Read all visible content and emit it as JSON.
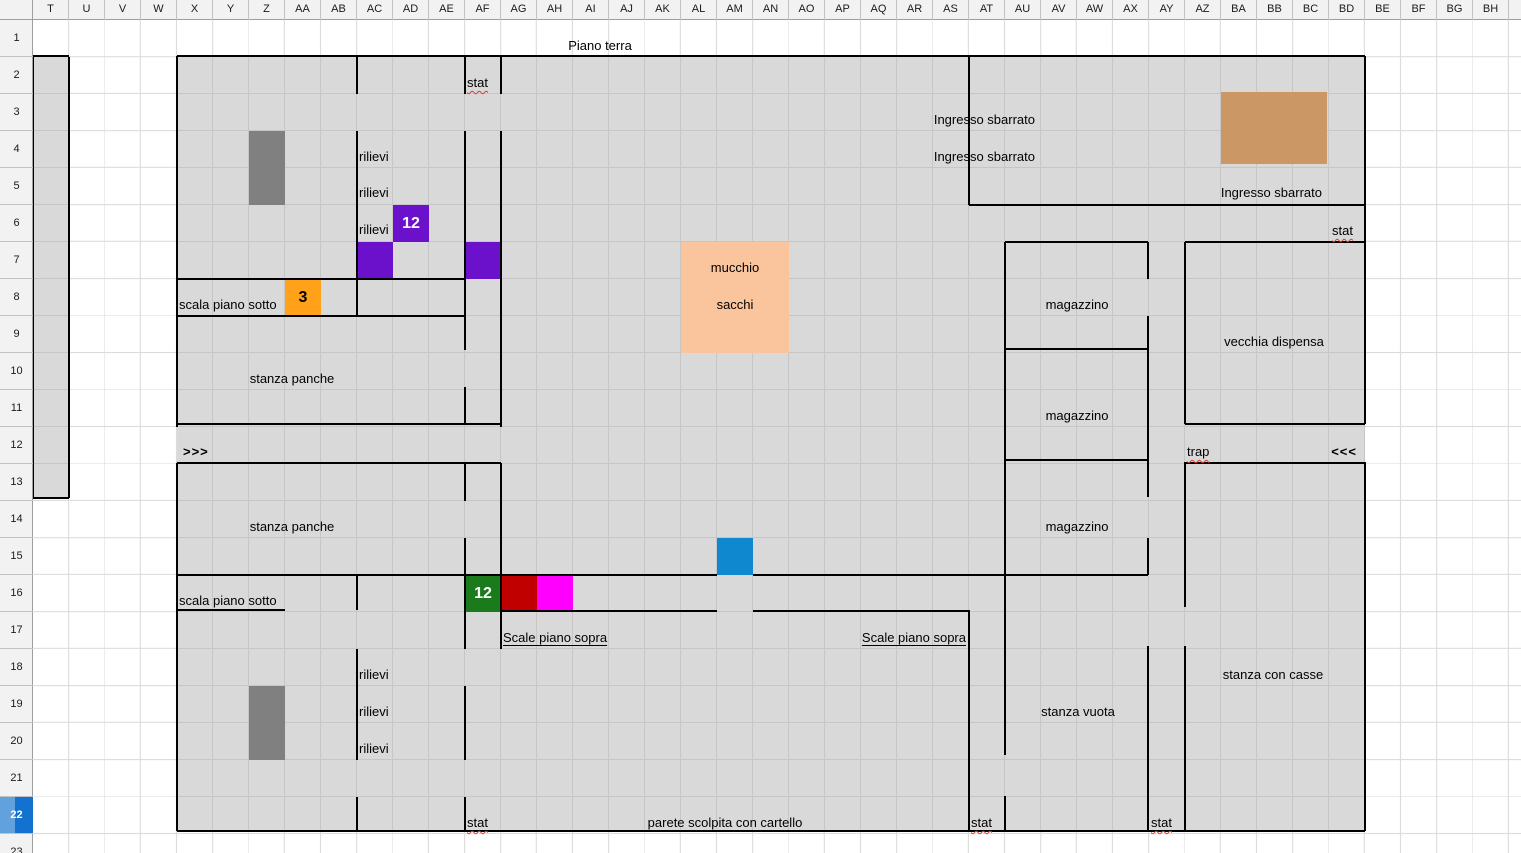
{
  "sheet": {
    "title_cell_text": "Piano terra",
    "column_headers": [
      "T",
      "U",
      "V",
      "W",
      "X",
      "Y",
      "Z",
      "AA",
      "AB",
      "AC",
      "AD",
      "AE",
      "AF",
      "AG",
      "AH",
      "AI",
      "AJ",
      "AK",
      "AL",
      "AM",
      "AN",
      "AO",
      "AP",
      "AQ",
      "AR",
      "AS",
      "AT",
      "AU",
      "AV",
      "AW",
      "AX",
      "AY",
      "AZ",
      "BA",
      "BB",
      "BC",
      "BD",
      "BE",
      "BF",
      "BG",
      "BH"
    ],
    "row_headers": [
      "1",
      "2",
      "3",
      "4",
      "5",
      "6",
      "7",
      "8",
      "9",
      "10",
      "11",
      "12",
      "13",
      "14",
      "15",
      "16",
      "17",
      "18",
      "19",
      "20",
      "21",
      "22",
      "23"
    ],
    "selected_row": "22"
  },
  "colors": {
    "map_fill": "#d9d9d9",
    "map_grid": "#c6c6c6",
    "sheet_grid": "#dcdcdc",
    "wall": "#000000",
    "dark_gray_cell": "#808080",
    "purple_cell": "#6c11cb",
    "orange_cell": "#ffa21a",
    "peach_block": "#fac49c",
    "blue_cell": "#1088d0",
    "green_cell": "#1b7a1b",
    "dark_red_cell": "#c00000",
    "magenta_cell": "#ff00ff",
    "tan_shape": "#cb9765",
    "header_bg": "#f2f2f2",
    "selected_row_blue": "#1371d0",
    "squiggle_red": "#e03a2f"
  },
  "map": {
    "regions": [
      {
        "name": "map-floor",
        "x": 177,
        "y": 57,
        "w": 1188,
        "h": 774,
        "rows": true
      },
      {
        "name": "stairs-strip-T-column",
        "x": 33,
        "y": 57,
        "w": 36,
        "h": 441,
        "rows": false
      }
    ],
    "labels": [
      {
        "name": "label-piano-terra",
        "text": "Piano terra",
        "x": 600,
        "y": 46,
        "align": "center"
      },
      {
        "name": "label-stat-af2",
        "text": "stat",
        "x": 467,
        "y": 83,
        "align": "left",
        "squiggle": true
      },
      {
        "name": "label-ingresso-sbarrato-r3",
        "text": "Ingresso sbarrato",
        "x": 1035,
        "y": 120,
        "align": "right"
      },
      {
        "name": "label-rilievi-r4",
        "text": "rilievi",
        "x": 359,
        "y": 157,
        "align": "left"
      },
      {
        "name": "label-ingresso-sbarrato-r4",
        "text": "Ingresso sbarrato",
        "x": 1035,
        "y": 157,
        "align": "right"
      },
      {
        "name": "label-rilievi-r5",
        "text": "rilievi",
        "x": 359,
        "y": 193,
        "align": "left"
      },
      {
        "name": "label-ingresso-sbarrato-r5",
        "text": "Ingresso sbarrato",
        "x": 1322,
        "y": 193,
        "align": "right"
      },
      {
        "name": "label-rilievi-r6",
        "text": "rilievi",
        "x": 359,
        "y": 230,
        "align": "left"
      },
      {
        "name": "label-stat-bd6",
        "text": "stat",
        "x": 1332,
        "y": 231,
        "align": "left",
        "squiggle": true
      },
      {
        "name": "label-mucchio",
        "text": "mucchio",
        "x": 735,
        "y": 268,
        "align": "center"
      },
      {
        "name": "label-sacchi",
        "text": "sacchi",
        "x": 735,
        "y": 305,
        "align": "center"
      },
      {
        "name": "label-scala-piano-sotto-r8",
        "text": "scala piano sotto",
        "x": 179,
        "y": 305,
        "align": "left"
      },
      {
        "name": "label-magazzino-r8",
        "text": "magazzino",
        "x": 1077,
        "y": 305,
        "align": "center"
      },
      {
        "name": "label-vecchia-dispensa",
        "text": "vecchia dispensa",
        "x": 1274,
        "y": 342,
        "align": "center"
      },
      {
        "name": "label-stanza-panche-r10",
        "text": "stanza panche",
        "x": 292,
        "y": 379,
        "align": "center"
      },
      {
        "name": "label-magazzino-r11",
        "text": "magazzino",
        "x": 1077,
        "y": 416,
        "align": "center"
      },
      {
        "name": "label-arrows-east",
        "text": ">>>",
        "x": 183,
        "y": 452,
        "align": "left",
        "bold": true
      },
      {
        "name": "label-trap",
        "text": "trap",
        "x": 1187,
        "y": 452,
        "align": "left",
        "squiggle": true
      },
      {
        "name": "label-arrows-west",
        "text": "<<<",
        "x": 1357,
        "y": 452,
        "align": "right",
        "bold": true
      },
      {
        "name": "label-stanza-panche-r14",
        "text": "stanza panche",
        "x": 292,
        "y": 527,
        "align": "center"
      },
      {
        "name": "label-magazzino-r14",
        "text": "magazzino",
        "x": 1077,
        "y": 527,
        "align": "center"
      },
      {
        "name": "label-scala-piano-sotto-r16",
        "text": "scala piano sotto",
        "x": 179,
        "y": 601,
        "align": "left"
      },
      {
        "name": "label-scale-piano-sopra-west",
        "text": "Scale piano sopra",
        "x": 503,
        "y": 638,
        "align": "left",
        "underline": true
      },
      {
        "name": "label-scale-piano-sopra-east",
        "text": "Scale piano sopra",
        "x": 966,
        "y": 638,
        "align": "right",
        "underline": true
      },
      {
        "name": "label-rilievi-r18",
        "text": "rilievi",
        "x": 359,
        "y": 675,
        "align": "left"
      },
      {
        "name": "label-stanza-con-casse",
        "text": "stanza con casse",
        "x": 1273,
        "y": 675,
        "align": "center"
      },
      {
        "name": "label-rilievi-r19",
        "text": "rilievi",
        "x": 359,
        "y": 712,
        "align": "left"
      },
      {
        "name": "label-stanza-vuota",
        "text": "stanza vuota",
        "x": 1078,
        "y": 712,
        "align": "center"
      },
      {
        "name": "label-rilievi-r20",
        "text": "rilievi",
        "x": 359,
        "y": 749,
        "align": "left"
      },
      {
        "name": "label-parete-scolpita",
        "text": "parete scolpita con cartello",
        "x": 725,
        "y": 823,
        "align": "center"
      },
      {
        "name": "label-stat-af22",
        "text": "stat",
        "x": 467,
        "y": 823,
        "align": "left",
        "squiggle": true
      },
      {
        "name": "label-stat-at22",
        "text": "stat",
        "x": 971,
        "y": 823,
        "align": "left",
        "squiggle": true
      },
      {
        "name": "label-stat-ay22",
        "text": "stat",
        "x": 1151,
        "y": 823,
        "align": "left",
        "squiggle": true
      }
    ],
    "cells": [
      {
        "name": "gray-cell-Z4",
        "x": 249,
        "y": 131,
        "w": 36,
        "h": 37,
        "color": "#808080"
      },
      {
        "name": "gray-cell-Z5",
        "x": 249,
        "y": 168,
        "w": 36,
        "h": 37,
        "color": "#808080"
      },
      {
        "name": "purple-cell-AD6",
        "x": 393,
        "y": 205,
        "w": 36,
        "h": 37,
        "color": "#6c11cb",
        "label": "12",
        "label_color": "#ffffff"
      },
      {
        "name": "purple-cell-AC7",
        "x": 357,
        "y": 242,
        "w": 36,
        "h": 37,
        "color": "#6c11cb"
      },
      {
        "name": "purple-cell-AF7",
        "x": 465,
        "y": 242,
        "w": 36,
        "h": 37,
        "color": "#6c11cb"
      },
      {
        "name": "orange-cell-AA8",
        "x": 285,
        "y": 279,
        "w": 36,
        "h": 37,
        "color": "#ffa21a",
        "label": "3",
        "label_color": "#000000"
      },
      {
        "name": "peach-block-sacks",
        "x": 681,
        "y": 242,
        "w": 108,
        "h": 111,
        "color": "#fac49c"
      },
      {
        "name": "blue-cell-AM15",
        "x": 717,
        "y": 538,
        "w": 36,
        "h": 37,
        "color": "#1088d0"
      },
      {
        "name": "green-cell-AF16",
        "x": 465,
        "y": 575,
        "w": 36,
        "h": 37,
        "color": "#1b7a1b",
        "label": "12",
        "label_color": "#ffffff"
      },
      {
        "name": "darkred-cell-AG16",
        "x": 501,
        "y": 575,
        "w": 36,
        "h": 37,
        "color": "#c00000"
      },
      {
        "name": "magenta-cell-AH16",
        "x": 537,
        "y": 575,
        "w": 36,
        "h": 37,
        "color": "#ff00ff"
      },
      {
        "name": "gray-cell-Z19",
        "x": 249,
        "y": 686,
        "w": 36,
        "h": 37,
        "color": "#808080"
      },
      {
        "name": "gray-cell-Z20",
        "x": 249,
        "y": 723,
        "w": 36,
        "h": 37,
        "color": "#808080"
      },
      {
        "name": "tan-rectangle",
        "x": 1221,
        "y": 92,
        "w": 106,
        "h": 72,
        "color": "#cb9765"
      }
    ],
    "walls": {
      "horizontal": [
        [
          56,
          33,
          69
        ],
        [
          56,
          177,
          1365
        ],
        [
          205,
          969,
          1365
        ],
        [
          242,
          1005,
          1148
        ],
        [
          242,
          1185,
          1365
        ],
        [
          279,
          177,
          465
        ],
        [
          316,
          177,
          465
        ],
        [
          349,
          1005,
          1148
        ],
        [
          424,
          177,
          501
        ],
        [
          424,
          1185,
          1365
        ],
        [
          460,
          1005,
          1148
        ],
        [
          463,
          177,
          501
        ],
        [
          463,
          1185,
          1365
        ],
        [
          498,
          33,
          69
        ],
        [
          575,
          177,
          717
        ],
        [
          575,
          753,
          1148
        ],
        [
          610,
          177,
          285
        ],
        [
          611,
          501,
          717
        ],
        [
          611,
          753,
          969
        ],
        [
          831,
          177,
          1365
        ]
      ],
      "vertical": [
        [
          33,
          57,
          498
        ],
        [
          69,
          57,
          498
        ],
        [
          177,
          56,
          427
        ],
        [
          177,
          463,
          831
        ],
        [
          357,
          57,
          94
        ],
        [
          357,
          131,
          316
        ],
        [
          357,
          575,
          610
        ],
        [
          357,
          649,
          760
        ],
        [
          357,
          797,
          831
        ],
        [
          465,
          57,
          94
        ],
        [
          465,
          131,
          350
        ],
        [
          465,
          387,
          424
        ],
        [
          465,
          463,
          501
        ],
        [
          465,
          538,
          649
        ],
        [
          465,
          686,
          760
        ],
        [
          465,
          797,
          831
        ],
        [
          501,
          57,
          94
        ],
        [
          501,
          131,
          427
        ],
        [
          501,
          463,
          649
        ],
        [
          969,
          56,
          205
        ],
        [
          969,
          610,
          831
        ],
        [
          1005,
          242,
          755
        ],
        [
          1005,
          796,
          831
        ],
        [
          1148,
          242,
          279
        ],
        [
          1148,
          316,
          497
        ],
        [
          1148,
          538,
          575
        ],
        [
          1148,
          646,
          831
        ],
        [
          1185,
          242,
          424
        ],
        [
          1185,
          462,
          607
        ],
        [
          1185,
          646,
          831
        ],
        [
          1365,
          56,
          424
        ],
        [
          1365,
          462,
          831
        ]
      ]
    }
  }
}
